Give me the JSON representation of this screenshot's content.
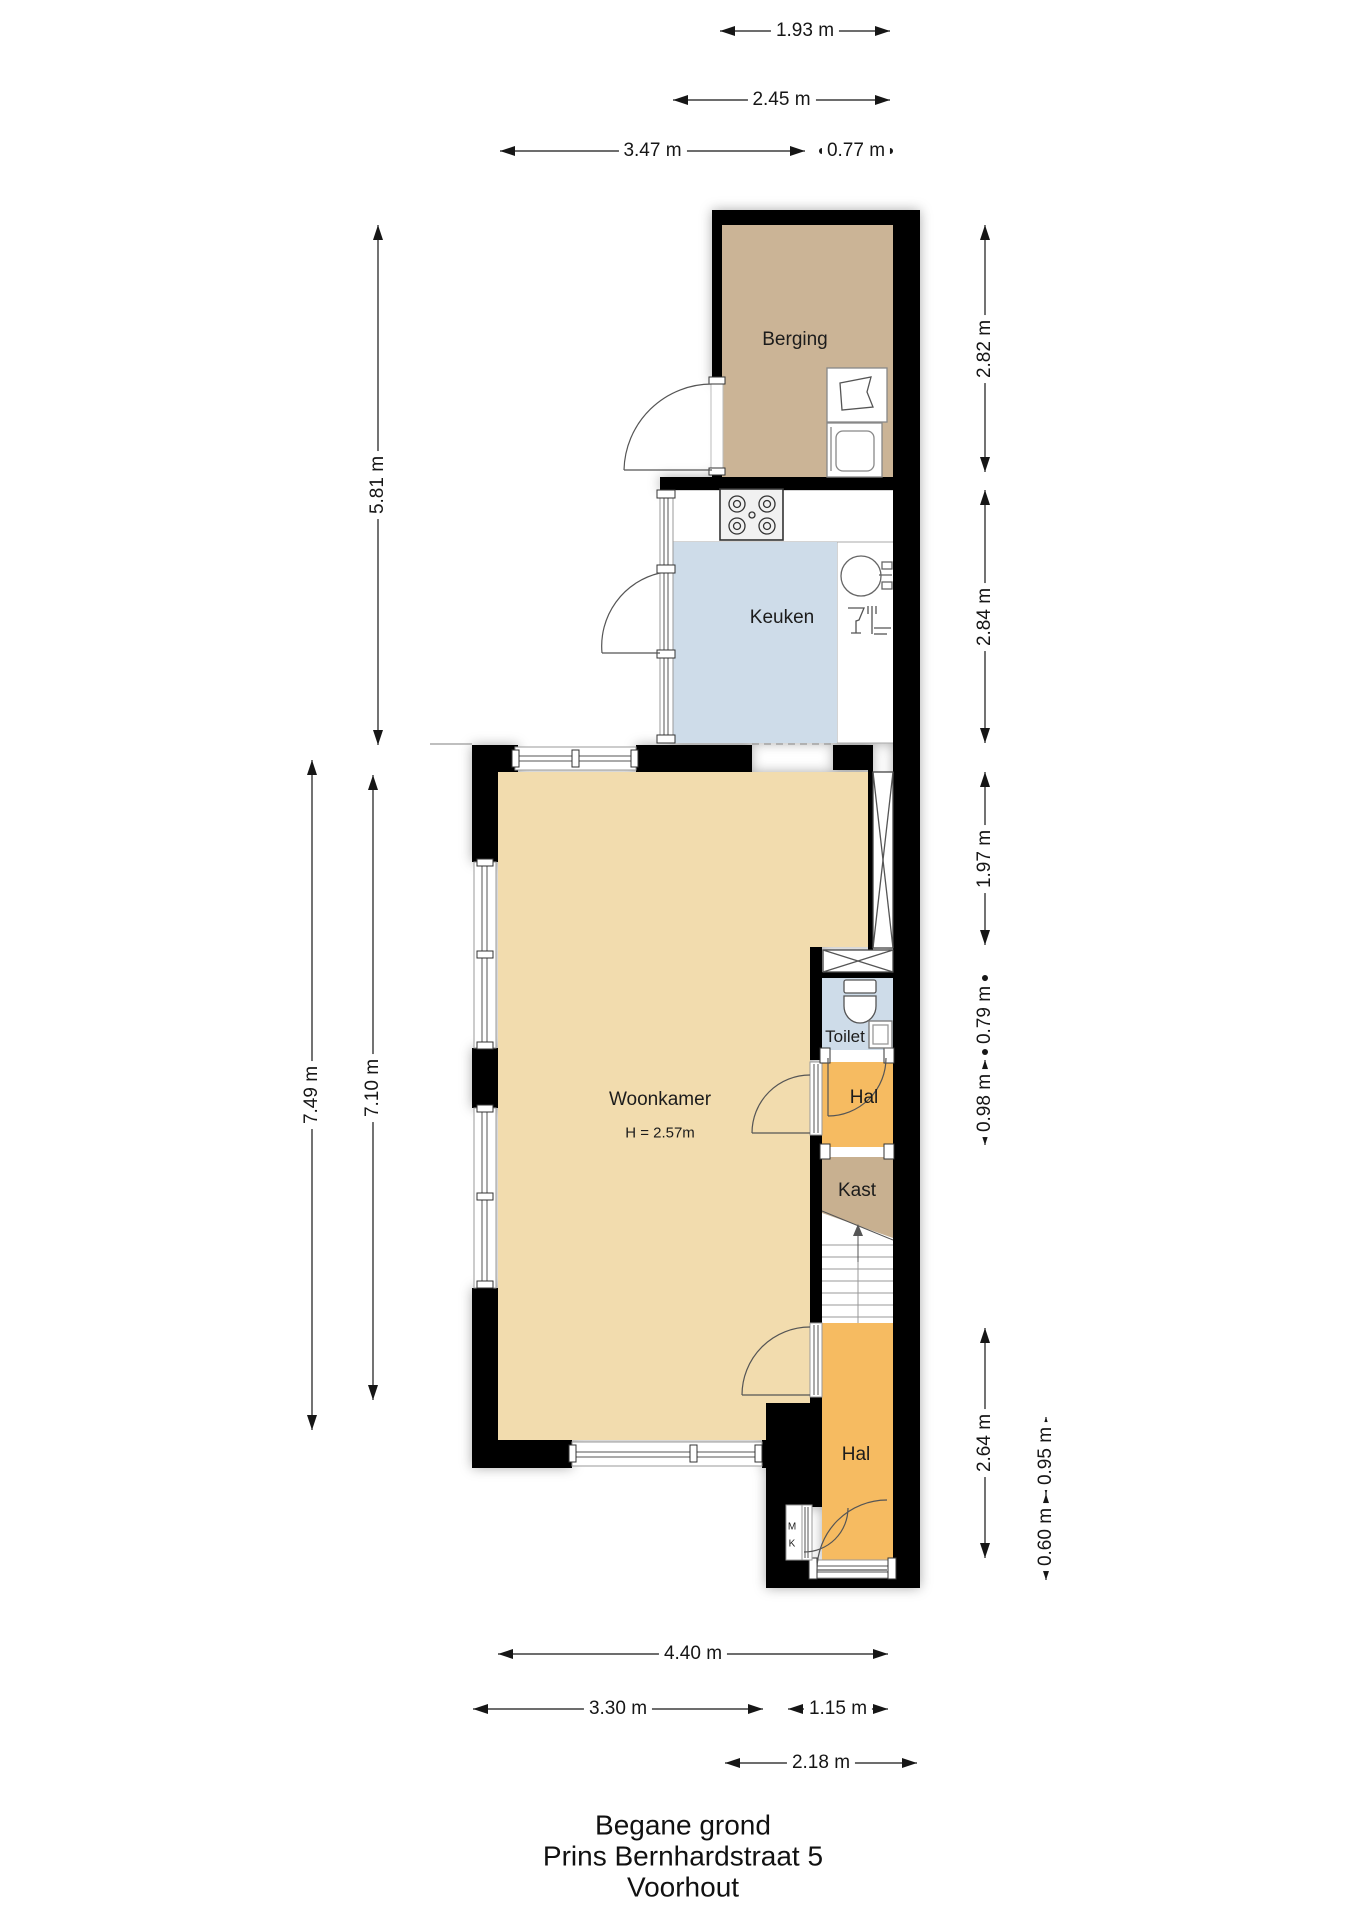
{
  "canvas": {
    "width": 1358,
    "height": 1920
  },
  "title": {
    "line1": "Begane grond",
    "line2": "Prins Bernhardstraat 5",
    "line3": "Voorhout"
  },
  "colors": {
    "wall": "#000000",
    "berging_floor": "#cbb496",
    "kast_floor": "#c8b090",
    "keuken_floor": "#cedce9",
    "toilet_floor": "#cedce9",
    "woonkamer_floor": "#f2dcae",
    "hal_floor": "#f6bb61",
    "dim_text": "#161616",
    "door_stroke": "#555555",
    "frame_stroke": "#9a9a9a"
  },
  "room_labels": [
    {
      "id": "berging",
      "text": "Berging",
      "x": 795,
      "y": 340,
      "size": 19
    },
    {
      "id": "keuken",
      "text": "Keuken",
      "x": 782,
      "y": 618,
      "size": 19
    },
    {
      "id": "woonkamer",
      "text": "Woonkamer",
      "x": 660,
      "y": 1100,
      "size": 19
    },
    {
      "id": "woonkamer-height",
      "text": "H = 2.57m",
      "x": 660,
      "y": 1133,
      "size": 15
    },
    {
      "id": "toilet",
      "text": "Toilet",
      "x": 845,
      "y": 1037,
      "size": 17
    },
    {
      "id": "hal-middle",
      "text": "Hal",
      "x": 864,
      "y": 1098,
      "size": 19
    },
    {
      "id": "kast",
      "text": "Kast",
      "x": 857,
      "y": 1191,
      "size": 19
    },
    {
      "id": "hal-bottom",
      "text": "Hal",
      "x": 856,
      "y": 1455,
      "size": 19
    },
    {
      "id": "meterkast-m",
      "text": "M",
      "x": 792,
      "y": 1527,
      "size": 10
    },
    {
      "id": "meterkast-k",
      "text": "K",
      "x": 792,
      "y": 1544,
      "size": 10
    }
  ],
  "dimensions": [
    {
      "label": "1.93 m",
      "orient": "h",
      "pos": 31,
      "from": 720,
      "to": 890,
      "ends": "arrow"
    },
    {
      "label": "2.45 m",
      "orient": "h",
      "pos": 100,
      "from": 673,
      "to": 890,
      "ends": "arrow"
    },
    {
      "label": "3.47 m",
      "orient": "h",
      "pos": 151,
      "from": 500,
      "to": 805,
      "ends": "arrow"
    },
    {
      "label": "0.77 m",
      "orient": "h",
      "pos": 151,
      "from": 822,
      "to": 890,
      "ends": "dot"
    },
    {
      "label": "4.40 m",
      "orient": "h",
      "pos": 1654,
      "from": 498,
      "to": 888,
      "ends": "arrow"
    },
    {
      "label": "3.30 m",
      "orient": "h",
      "pos": 1709,
      "from": 473,
      "to": 763,
      "ends": "arrow"
    },
    {
      "label": "1.15 m",
      "orient": "h",
      "pos": 1709,
      "from": 788,
      "to": 888,
      "ends": "arrow"
    },
    {
      "label": "2.18 m",
      "orient": "h",
      "pos": 1763,
      "from": 725,
      "to": 917,
      "ends": "arrow"
    },
    {
      "label": "5.81 m",
      "orient": "v",
      "pos": 378,
      "from": 225,
      "to": 745,
      "ends": "arrow"
    },
    {
      "label": "7.49 m",
      "orient": "v",
      "pos": 312,
      "from": 760,
      "to": 1430,
      "ends": "arrow"
    },
    {
      "label": "7.10 m",
      "orient": "v",
      "pos": 373,
      "from": 775,
      "to": 1400,
      "ends": "arrow"
    },
    {
      "label": "2.82 m",
      "orient": "v",
      "pos": 985,
      "from": 225,
      "to": 472,
      "ends": "arrow"
    },
    {
      "label": "2.84 m",
      "orient": "v",
      "pos": 985,
      "from": 490,
      "to": 743,
      "ends": "arrow"
    },
    {
      "label": "1.97 m",
      "orient": "v",
      "pos": 985,
      "from": 772,
      "to": 945,
      "ends": "arrow"
    },
    {
      "label": "0.79 m",
      "orient": "v",
      "pos": 985,
      "from": 978,
      "to": 1052,
      "ends": "dot"
    },
    {
      "label": "0.98 m",
      "orient": "v",
      "pos": 985,
      "from": 1060,
      "to": 1145,
      "ends": "arrow"
    },
    {
      "label": "2.64 m",
      "orient": "v",
      "pos": 985,
      "from": 1328,
      "to": 1558,
      "ends": "arrow"
    },
    {
      "label": "0.95 m",
      "orient": "v",
      "pos": 1046,
      "from": 1417,
      "to": 1494,
      "ends": "arrow"
    },
    {
      "label": "0.60 m",
      "orient": "v",
      "pos": 1046,
      "from": 1494,
      "to": 1580,
      "ends": "arrow"
    }
  ]
}
